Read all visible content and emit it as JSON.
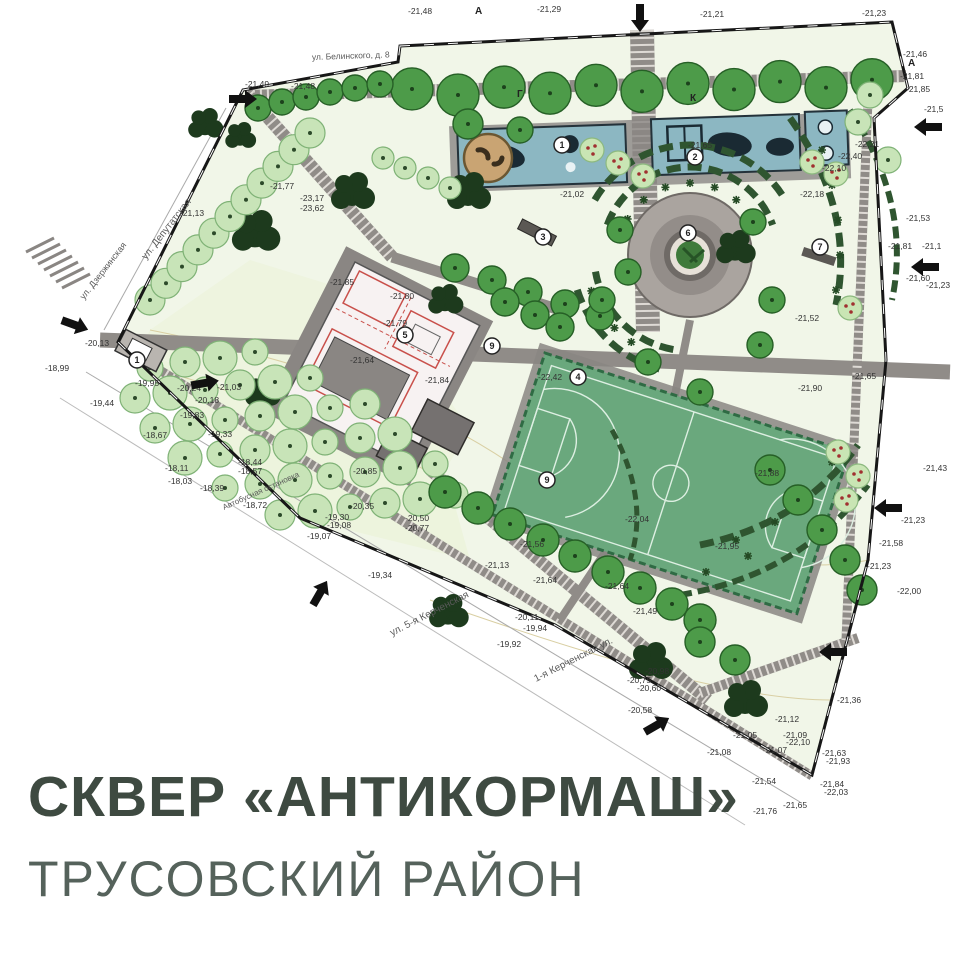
{
  "title": {
    "line1": "СКВЕР «АНТИКОРМАШ»",
    "line2": "ТРУСОВСКИЙ РАЙОН"
  },
  "colors": {
    "title_text": "#3e4a41",
    "subtitle_text": "#55625b",
    "park_base": "#f1f6e8",
    "meadow": "#ecf4dc",
    "path_gray": "#908c88",
    "boundary": "#171717",
    "tree_green": "#4d9b49",
    "tree_pale": "#c8e4b8",
    "tree_dark": "#1d3a1d",
    "hedge_green": "#2f5530",
    "playground_blue": "#8cb7c2",
    "court_green": "#6aa87d",
    "workout_red": "#c9504b",
    "sandbox_tan": "#c9a473"
  },
  "map": {
    "street_labels": [
      {
        "t": "ул. Белинского, д. 8",
        "x": 312,
        "y": 60,
        "rot": -2,
        "s": 8.5
      },
      {
        "t": "ул. Депутатская",
        "x": 146,
        "y": 260,
        "rot": -52,
        "s": 10
      },
      {
        "t": "ул. Дзержинская",
        "x": 84,
        "y": 300,
        "rot": -52,
        "s": 9
      },
      {
        "t": "ул. 5-я Керченская",
        "x": 392,
        "y": 636,
        "rot": -27,
        "s": 10
      },
      {
        "t": "1-я Керченская ул.",
        "x": 536,
        "y": 682,
        "rot": -27,
        "s": 10
      },
      {
        "t": "Автобусная остановка",
        "x": 224,
        "y": 510,
        "rot": -24,
        "s": 8
      }
    ],
    "axis_letters": [
      {
        "t": "А",
        "x": 475,
        "y": 14
      },
      {
        "t": "А",
        "x": 908,
        "y": 66
      },
      {
        "t": "Г",
        "x": 517,
        "y": 97
      },
      {
        "t": "К",
        "x": 690,
        "y": 101
      }
    ],
    "elevation_labels": [
      {
        "x": 408,
        "y": 14,
        "t": "-21,48"
      },
      {
        "x": 537,
        "y": 12,
        "t": "-21,29"
      },
      {
        "x": 700,
        "y": 17,
        "t": "-21,21"
      },
      {
        "x": 862,
        "y": 16,
        "t": "-21,23"
      },
      {
        "x": 245,
        "y": 87,
        "t": "-21,49"
      },
      {
        "x": 291,
        "y": 89,
        "t": "-21,48"
      },
      {
        "x": 903,
        "y": 57,
        "t": "-21,46"
      },
      {
        "x": 900,
        "y": 79,
        "t": "-21,81"
      },
      {
        "x": 906,
        "y": 92,
        "t": "-21,85"
      },
      {
        "x": 924,
        "y": 112,
        "t": "-21,5"
      },
      {
        "x": 688,
        "y": 148,
        "t": "-21,65"
      },
      {
        "x": 560,
        "y": 197,
        "t": "-21,02"
      },
      {
        "x": 855,
        "y": 147,
        "t": "-22,21"
      },
      {
        "x": 838,
        "y": 159,
        "t": "-22,40"
      },
      {
        "x": 822,
        "y": 171,
        "t": "-22,10"
      },
      {
        "x": 800,
        "y": 197,
        "t": "-22,18"
      },
      {
        "x": 906,
        "y": 221,
        "t": "-21,53"
      },
      {
        "x": 888,
        "y": 249,
        "t": "-21,81"
      },
      {
        "x": 922,
        "y": 249,
        "t": "-21,1"
      },
      {
        "x": 906,
        "y": 281,
        "t": "-21,60"
      },
      {
        "x": 926,
        "y": 288,
        "t": "-21,23"
      },
      {
        "x": 795,
        "y": 321,
        "t": "-21,52"
      },
      {
        "x": 852,
        "y": 379,
        "t": "-21,65"
      },
      {
        "x": 798,
        "y": 391,
        "t": "-21,90"
      },
      {
        "x": 923,
        "y": 471,
        "t": "-21,43"
      },
      {
        "x": 901,
        "y": 523,
        "t": "-21,23"
      },
      {
        "x": 879,
        "y": 546,
        "t": "-21,58"
      },
      {
        "x": 867,
        "y": 569,
        "t": "-21,23"
      },
      {
        "x": 897,
        "y": 594,
        "t": "-22,00"
      },
      {
        "x": 270,
        "y": 189,
        "t": "-21,77"
      },
      {
        "x": 300,
        "y": 201,
        "t": "-23,17"
      },
      {
        "x": 300,
        "y": 211,
        "t": "-23,62"
      },
      {
        "x": 180,
        "y": 216,
        "t": "-21,13"
      },
      {
        "x": 85,
        "y": 346,
        "t": "-20,13"
      },
      {
        "x": 45,
        "y": 371,
        "t": "-18,99"
      },
      {
        "x": 135,
        "y": 386,
        "t": "-19,95"
      },
      {
        "x": 90,
        "y": 406,
        "t": "-19,44"
      },
      {
        "x": 177,
        "y": 391,
        "t": "-20,24"
      },
      {
        "x": 217,
        "y": 390,
        "t": "-21,03"
      },
      {
        "x": 195,
        "y": 403,
        "t": "-20,18"
      },
      {
        "x": 180,
        "y": 418,
        "t": "-19,83"
      },
      {
        "x": 208,
        "y": 437,
        "t": "-19,33"
      },
      {
        "x": 143,
        "y": 438,
        "t": "-18,67"
      },
      {
        "x": 165,
        "y": 471,
        "t": "-18,11"
      },
      {
        "x": 168,
        "y": 484,
        "t": "-18,03"
      },
      {
        "x": 200,
        "y": 491,
        "t": "-18,39"
      },
      {
        "x": 238,
        "y": 465,
        "t": "-18,44"
      },
      {
        "x": 238,
        "y": 474,
        "t": "-18,57"
      },
      {
        "x": 243,
        "y": 508,
        "t": "-18,72"
      },
      {
        "x": 307,
        "y": 539,
        "t": "-19,07"
      },
      {
        "x": 353,
        "y": 474,
        "t": "-20,85"
      },
      {
        "x": 350,
        "y": 509,
        "t": "-20,35"
      },
      {
        "x": 325,
        "y": 520,
        "t": "-19,30"
      },
      {
        "x": 327,
        "y": 528,
        "t": "-19,08"
      },
      {
        "x": 405,
        "y": 521,
        "t": "-20,50"
      },
      {
        "x": 405,
        "y": 531,
        "t": "-20,77"
      },
      {
        "x": 330,
        "y": 285,
        "t": "-21,85"
      },
      {
        "x": 390,
        "y": 299,
        "t": "-21,80"
      },
      {
        "x": 383,
        "y": 326,
        "t": "-21,79"
      },
      {
        "x": 350,
        "y": 363,
        "t": "-21,64"
      },
      {
        "x": 425,
        "y": 383,
        "t": "-21,84"
      },
      {
        "x": 538,
        "y": 380,
        "t": "-22,42"
      },
      {
        "x": 755,
        "y": 476,
        "t": "-21,88"
      },
      {
        "x": 715,
        "y": 549,
        "t": "-21,95"
      },
      {
        "x": 625,
        "y": 522,
        "t": "-22,04"
      },
      {
        "x": 520,
        "y": 547,
        "t": "-21,56"
      },
      {
        "x": 485,
        "y": 568,
        "t": "-21,13"
      },
      {
        "x": 533,
        "y": 583,
        "t": "-21,64"
      },
      {
        "x": 605,
        "y": 589,
        "t": "-21,64"
      },
      {
        "x": 368,
        "y": 578,
        "t": "-19,34"
      },
      {
        "x": 515,
        "y": 620,
        "t": "-20,11"
      },
      {
        "x": 523,
        "y": 631,
        "t": "-19,94"
      },
      {
        "x": 497,
        "y": 647,
        "t": "-19,92"
      },
      {
        "x": 633,
        "y": 614,
        "t": "-21,49"
      },
      {
        "x": 645,
        "y": 674,
        "t": "-20,98"
      },
      {
        "x": 627,
        "y": 683,
        "t": "-20,75"
      },
      {
        "x": 637,
        "y": 691,
        "t": "-20,60"
      },
      {
        "x": 628,
        "y": 713,
        "t": "-20,58"
      },
      {
        "x": 733,
        "y": 738,
        "t": "-21,05"
      },
      {
        "x": 707,
        "y": 755,
        "t": "-21,08"
      },
      {
        "x": 763,
        "y": 753,
        "t": "-21,07"
      },
      {
        "x": 783,
        "y": 738,
        "t": "-21,09"
      },
      {
        "x": 786,
        "y": 745,
        "t": "-22,10"
      },
      {
        "x": 775,
        "y": 722,
        "t": "-21,12"
      },
      {
        "x": 837,
        "y": 703,
        "t": "-21,36"
      },
      {
        "x": 752,
        "y": 784,
        "t": "-21,54"
      },
      {
        "x": 822,
        "y": 756,
        "t": "-21,63"
      },
      {
        "x": 826,
        "y": 764,
        "t": "-21,93"
      },
      {
        "x": 820,
        "y": 787,
        "t": "-21,84"
      },
      {
        "x": 824,
        "y": 795,
        "t": "-22,03"
      },
      {
        "x": 783,
        "y": 808,
        "t": "-21,65"
      },
      {
        "x": 753,
        "y": 814,
        "t": "-21,76"
      }
    ],
    "area_markers": [
      {
        "n": "1",
        "x": 562,
        "y": 145
      },
      {
        "n": "2",
        "x": 695,
        "y": 157
      },
      {
        "n": "3",
        "x": 543,
        "y": 237
      },
      {
        "n": "5",
        "x": 405,
        "y": 335
      },
      {
        "n": "4",
        "x": 578,
        "y": 377
      },
      {
        "n": "6",
        "x": 688,
        "y": 233
      },
      {
        "n": "7",
        "x": 820,
        "y": 247
      },
      {
        "n": "9",
        "x": 492,
        "y": 346
      },
      {
        "n": "9",
        "x": 547,
        "y": 480
      },
      {
        "n": "1",
        "x": 137,
        "y": 360
      }
    ],
    "entrance_arrows": [
      {
        "x": 640,
        "y": 18,
        "rot": 90
      },
      {
        "x": 928,
        "y": 127,
        "rot": 180
      },
      {
        "x": 925,
        "y": 267,
        "rot": 180
      },
      {
        "x": 888,
        "y": 508,
        "rot": 180
      },
      {
        "x": 243,
        "y": 99,
        "rot": 0
      },
      {
        "x": 75,
        "y": 325,
        "rot": 20
      },
      {
        "x": 205,
        "y": 383,
        "rot": -10
      },
      {
        "x": 833,
        "y": 652,
        "rot": 180
      },
      {
        "x": 657,
        "y": 725,
        "rot": -30
      },
      {
        "x": 320,
        "y": 593,
        "rot": -60
      }
    ]
  }
}
